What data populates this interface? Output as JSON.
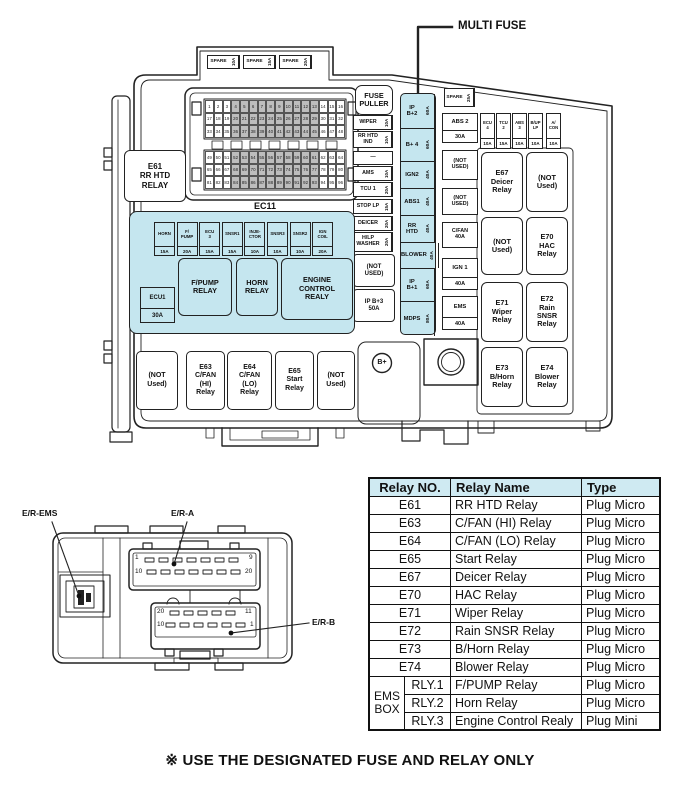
{
  "colors": {
    "highlight": "#c5e6ef",
    "table_header": "#cfeaf2"
  },
  "annotations": {
    "multi_fuse": "MULTI FUSE",
    "note": "※ USE THE DESIGNATED FUSE AND RELAY ONLY"
  },
  "fusebox": {
    "spare_top": [
      {
        "label": "SPARE",
        "amp": "10A"
      },
      {
        "label": "SPARE",
        "amp": "15A"
      },
      {
        "label": "SPARE",
        "amp": "20A"
      }
    ],
    "ec11_label": "EC11",
    "e61_relay": "E61\nRR HTD\nRELAY",
    "fuse_puller": "FUSE\nPULLER",
    "left_column": [
      {
        "label": "WIPER",
        "amp": "10A"
      },
      {
        "label": "RR HTD\nIND",
        "amp": "10A"
      },
      {
        "label": "—",
        "amp": ""
      },
      {
        "label": "AMS",
        "amp": "10A"
      },
      {
        "label": "TCU 1",
        "amp": "20A"
      },
      {
        "label": "STOP LP",
        "amp": "15A"
      },
      {
        "label": "DEICER",
        "amp": "20A"
      },
      {
        "label": "H/LP\nWASHER",
        "amp": "20A"
      }
    ],
    "not_used_left": "(NOT\nUSED)",
    "ip_b3": "IP B+3\n50A",
    "multi_fuse_strip": [
      {
        "label": "IP\nB+2",
        "amp": "60A"
      },
      {
        "label": "B+ 4",
        "amp": "60A"
      },
      {
        "label": "IGN2",
        "amp": "40A"
      },
      {
        "label": "ABS1",
        "amp": "40A"
      },
      {
        "label": "RR\nHTD",
        "amp": "40A"
      },
      {
        "label": "BLOWER",
        "amp": "40A"
      },
      {
        "label": "IP\nB+1",
        "amp": "60A"
      },
      {
        "label": "MDPS",
        "amp": "80A"
      }
    ],
    "spare_25": {
      "label": "SPARE",
      "amp": "25A"
    },
    "mid_column": [
      {
        "top": "ABS 2",
        "amp": "30A"
      },
      {
        "top": "(NOT\nUSED)",
        "amp": ""
      },
      {
        "top": "(NOT\nUSED)",
        "amp": ""
      },
      {
        "top": "C/FAN\n40A",
        "amp": ""
      },
      {
        "top": "IGN 1",
        "amp": "40A"
      },
      {
        "top": "EMS",
        "amp": "40A"
      }
    ],
    "small_fuses": [
      {
        "label": "ECU\n4",
        "amp": "10A"
      },
      {
        "label": "TCU\n2",
        "amp": "15A"
      },
      {
        "label": "ABS\n3",
        "amp": "10A"
      },
      {
        "label": "B/UP\nLP",
        "amp": "10A"
      },
      {
        "label": "A/\nCON",
        "amp": "10A"
      }
    ],
    "relay_grid": [
      "E67\nDeicer\nRelay",
      "(NOT\nUsed)",
      "(NOT\nUsed)",
      "E70\nHAC\nRelay",
      "E71\nWiper\nRelay",
      "E72\nRain\nSNSR\nRelay",
      "E73\nB/Horn\nRelay",
      "E74\nBlower\nRelay"
    ],
    "ems_box": {
      "fuses": [
        {
          "label": "HORN",
          "amp": "15A"
        },
        {
          "label": "F/\nPUMP",
          "amp": "20A"
        },
        {
          "label": "ECU\n3",
          "amp": "15A"
        },
        {
          "label": "SNSR1",
          "amp": "15A"
        },
        {
          "label": "INJE-\nCTOR",
          "amp": "10A"
        },
        {
          "label": "SNSR3",
          "amp": "10A"
        },
        {
          "label": "SNSR2",
          "amp": "10A"
        },
        {
          "label": "IGN\nCOIL",
          "amp": "20A"
        }
      ],
      "ecu1": {
        "top": "ECU1",
        "amp": "30A"
      },
      "relays": [
        "F/PUMP\nRELAY",
        "HORN\nRELAY",
        "ENGINE\nCONTROL\nREALY"
      ]
    },
    "bottom_row": [
      "(NOT\nUsed)",
      "E63\nC/FAN\n(HI)\nRelay",
      "E64\nC/FAN\n(LO)\nRelay",
      "E65\nStart\nRelay",
      "(NOT\nUsed)"
    ],
    "b_plus": "B+"
  },
  "connector_view": {
    "labels": {
      "ems": "E/R-EMS",
      "a": "E/R-A",
      "b": "E/R-B"
    },
    "era_pins": {
      "tl": "1",
      "tr": "9",
      "bl": "10",
      "br": "20"
    },
    "erb_pins": {
      "tl": "20",
      "tr": "11",
      "bl": "10",
      "br": "1"
    }
  },
  "relay_table": {
    "headers": [
      "Relay NO.",
      "Relay Name",
      "Type"
    ],
    "rows": [
      [
        "E61",
        "RR HTD Relay",
        "Plug Micro"
      ],
      [
        "E63",
        "C/FAN (HI) Relay",
        "Plug Micro"
      ],
      [
        "E64",
        "C/FAN (LO) Relay",
        "Plug Micro"
      ],
      [
        "E65",
        "Start Relay",
        "Plug Micro"
      ],
      [
        "E67",
        "Deicer Relay",
        "Plug Micro"
      ],
      [
        "E70",
        "HAC Relay",
        "Plug Micro"
      ],
      [
        "E71",
        "Wiper Relay",
        "Plug Micro"
      ],
      [
        "E72",
        "Rain SNSR Relay",
        "Plug Micro"
      ],
      [
        "E73",
        "B/Horn Relay",
        "Plug Micro"
      ],
      [
        "E74",
        "Blower Relay",
        "Plug Micro"
      ]
    ],
    "ems_group": {
      "label": "EMS\nBOX",
      "rows": [
        [
          "RLY.1",
          "F/PUMP Relay",
          "Plug Micro"
        ],
        [
          "RLY.2",
          "Horn Relay",
          "Plug Micro"
        ],
        [
          "RLY.3",
          "Engine Control Realy",
          "Plug Mini"
        ]
      ]
    }
  }
}
